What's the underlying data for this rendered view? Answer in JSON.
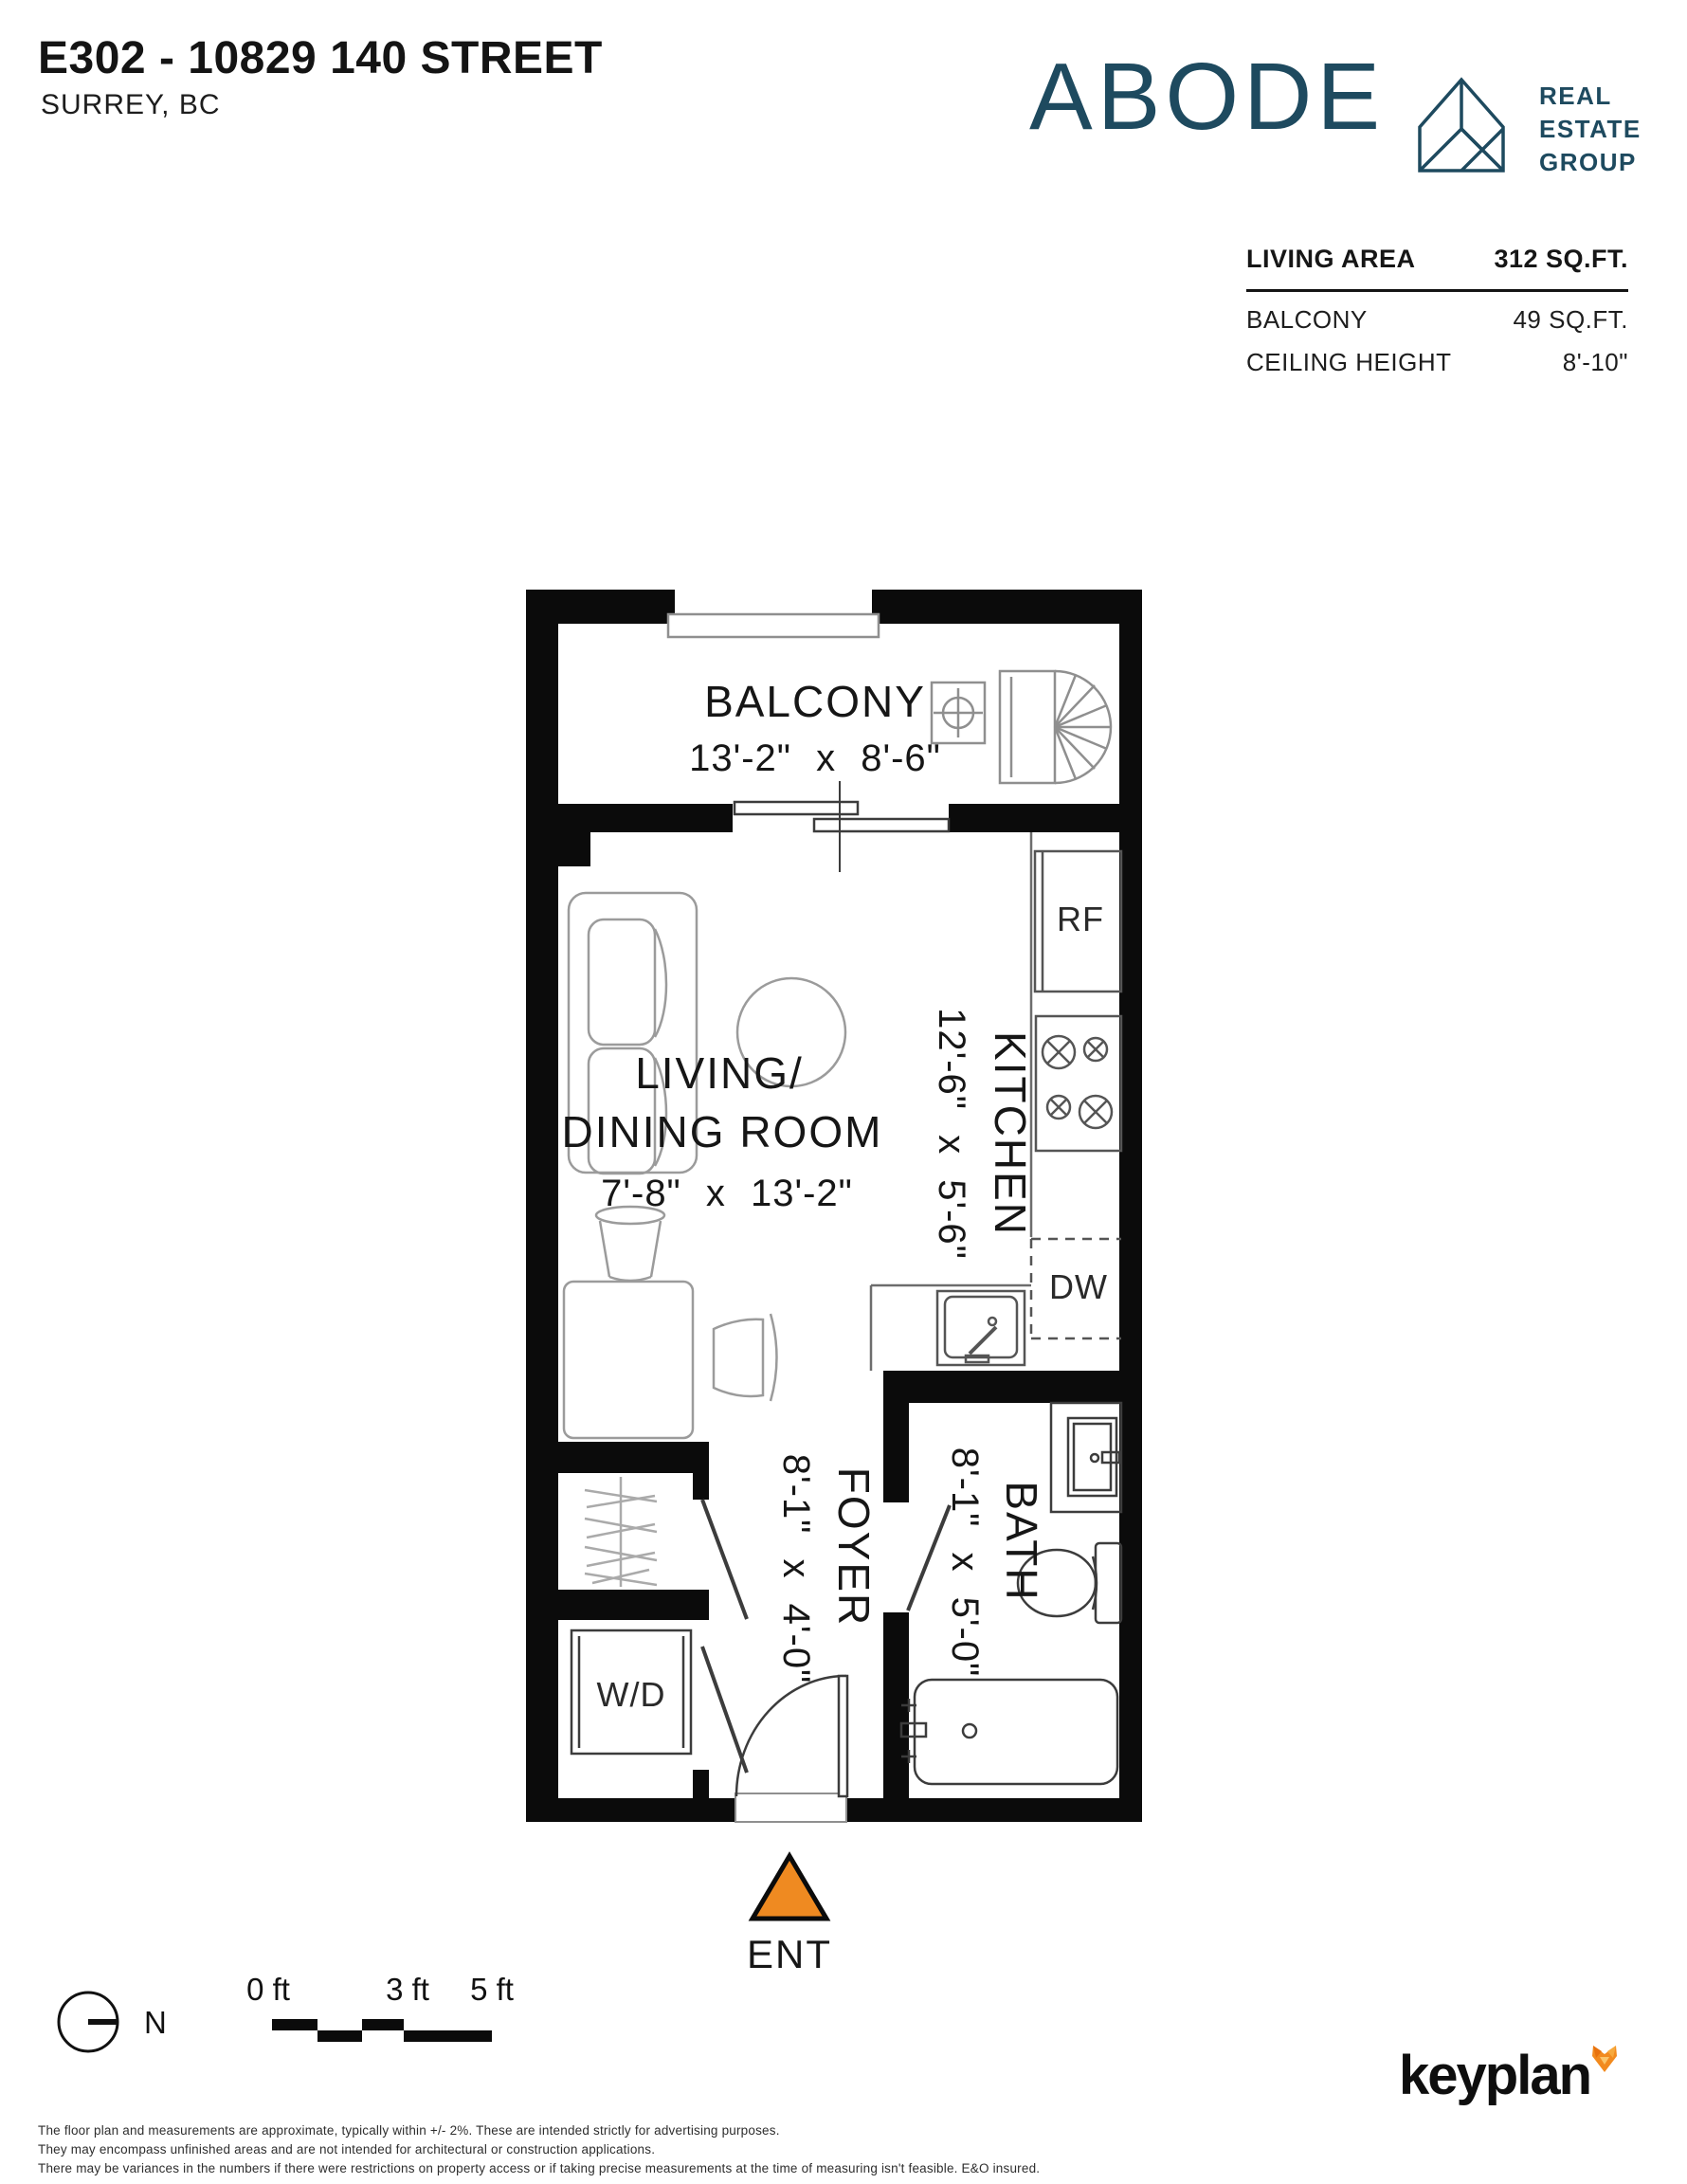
{
  "header": {
    "title": "E302 - 10829 140 STREET",
    "city": "SURREY, BC"
  },
  "brand": {
    "wordmark": "ABODE",
    "tagline_line1": "REAL",
    "tagline_line2": "ESTATE",
    "tagline_line3": "GROUP",
    "color": "#1E4A5F"
  },
  "area_table": {
    "rows": [
      {
        "label": "LIVING AREA",
        "value": "312 SQ.FT."
      },
      {
        "label": "BALCONY",
        "value": "49 SQ.FT."
      },
      {
        "label": "CEILING HEIGHT",
        "value": "8'-10\""
      }
    ]
  },
  "floorplan": {
    "rooms": {
      "balcony": {
        "name": "BALCONY",
        "dims": "13'-2\" x 8'-6\""
      },
      "living_dining": {
        "name_line1": "LIVING/",
        "name_line2": "DINING ROOM",
        "dims": "7'-8\" x 13'-2\""
      },
      "kitchen": {
        "name": "KITCHEN",
        "dims": "12'-6\" x 5'-6\""
      },
      "foyer": {
        "name": "FOYER",
        "dims": "8'-1\" x 4'-0\""
      },
      "bath": {
        "name": "BATH",
        "dims": "8'-1\" x 5'-0\""
      }
    },
    "labels": {
      "fridge": "RF",
      "dishwasher": "DW",
      "washer_dryer": "W/D",
      "entrance": "ENT"
    },
    "entrance_arrow_color": "#EF8A21"
  },
  "scale_bar": {
    "tick0": "0 ft",
    "tick3": "3 ft",
    "tick5": "5 ft"
  },
  "compass": {
    "north_label": "N"
  },
  "footer": {
    "disclaimer_line1": "The floor plan and measurements are approximate, typically within +/- 2%. These are intended strictly for advertising purposes.",
    "disclaimer_line2": "They may encompass unfinished areas and are not intended for architectural or construction applications.",
    "disclaimer_line3": "There may be variances in the numbers if there were restrictions on property access or if taking precise measurements at the time of measuring isn't feasible. E&O insured.",
    "keyplan_text": "keyplan",
    "fox_color": "#F28A1E"
  }
}
